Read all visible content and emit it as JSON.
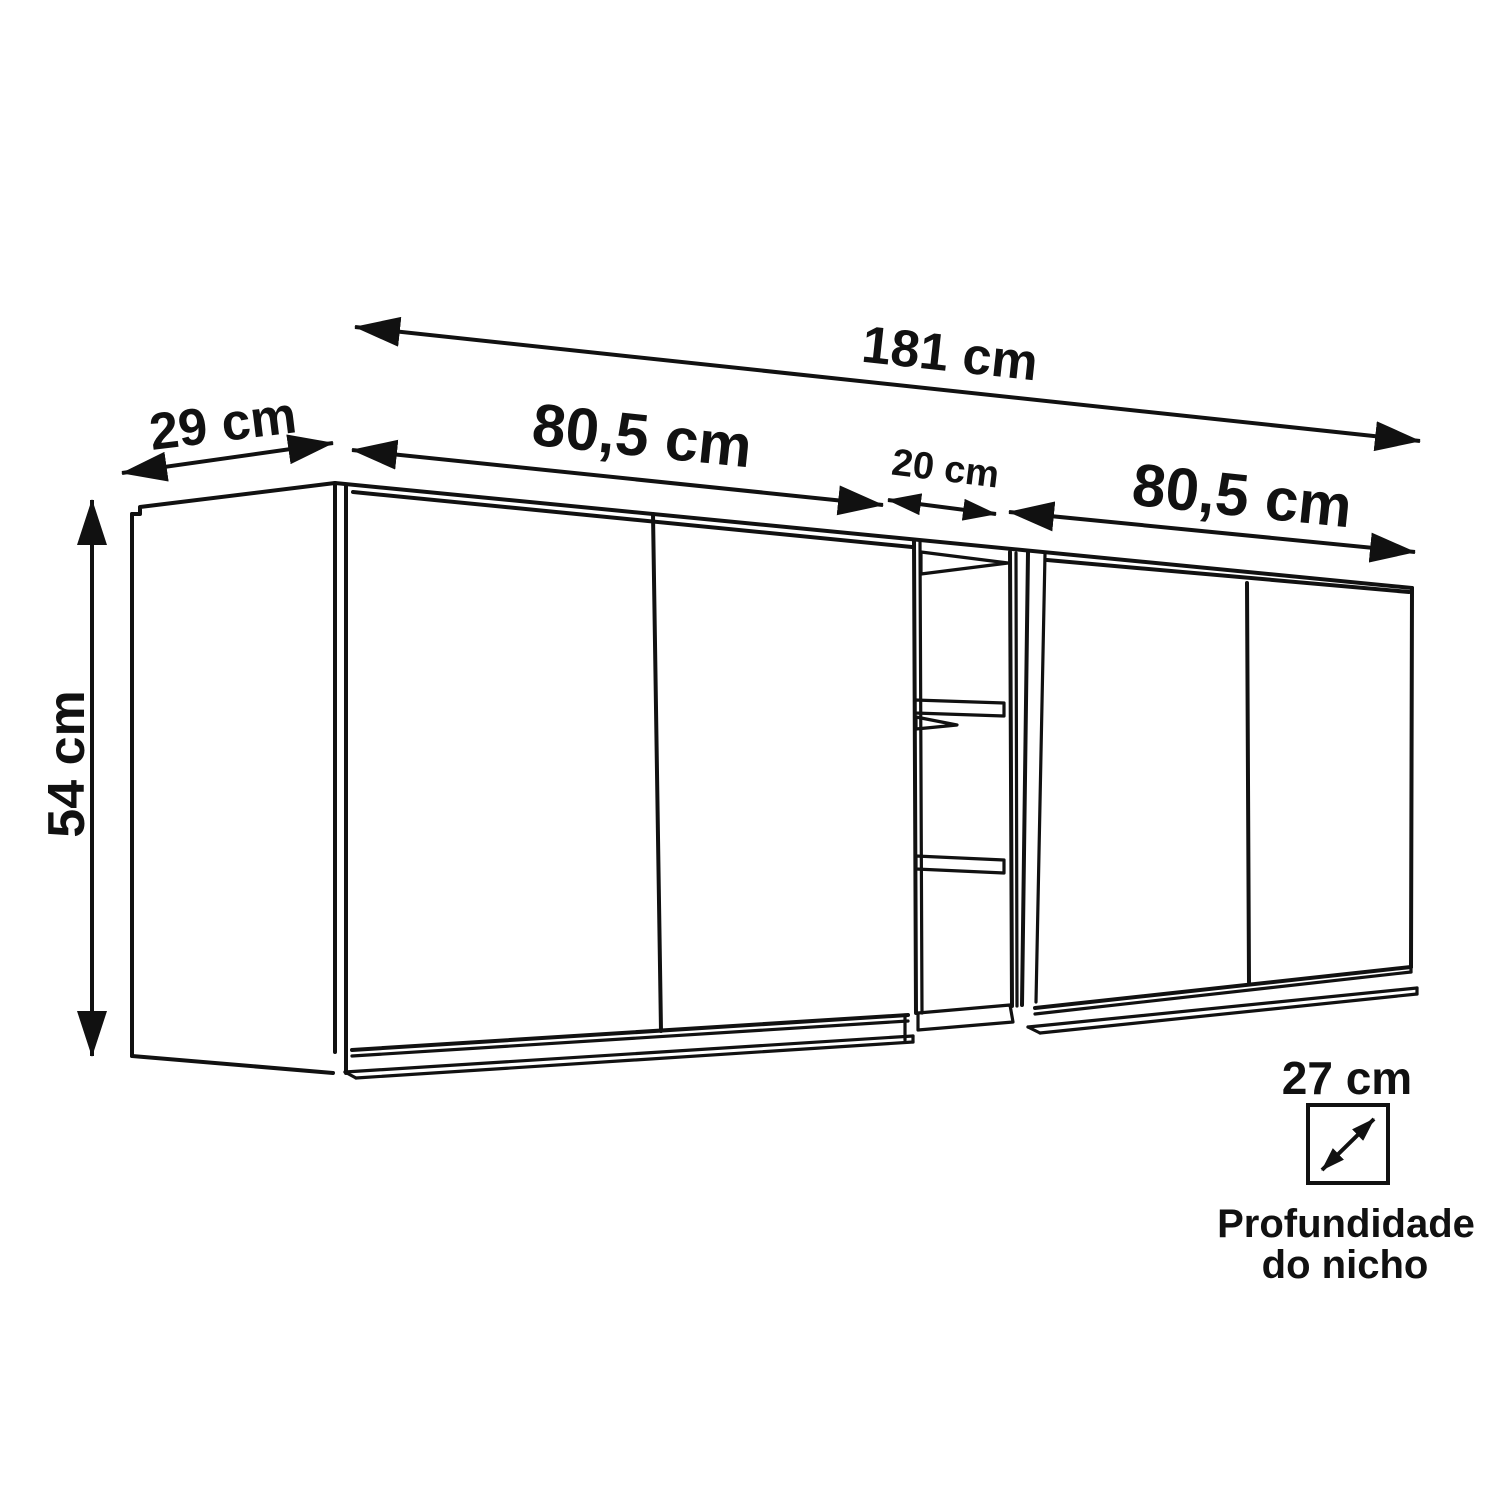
{
  "diagram": {
    "background": "#ffffff",
    "line_color": "#111111",
    "dimensions": {
      "total_width": "181 cm",
      "side_depth": "29 cm",
      "left_module_width": "80,5 cm",
      "niche_width": "20 cm",
      "right_module_width": "80,5 cm",
      "height": "54 cm",
      "niche_depth": "27 cm"
    },
    "niche_depth_caption_line1": "Profundidade",
    "niche_depth_caption_line2": "do nicho"
  }
}
